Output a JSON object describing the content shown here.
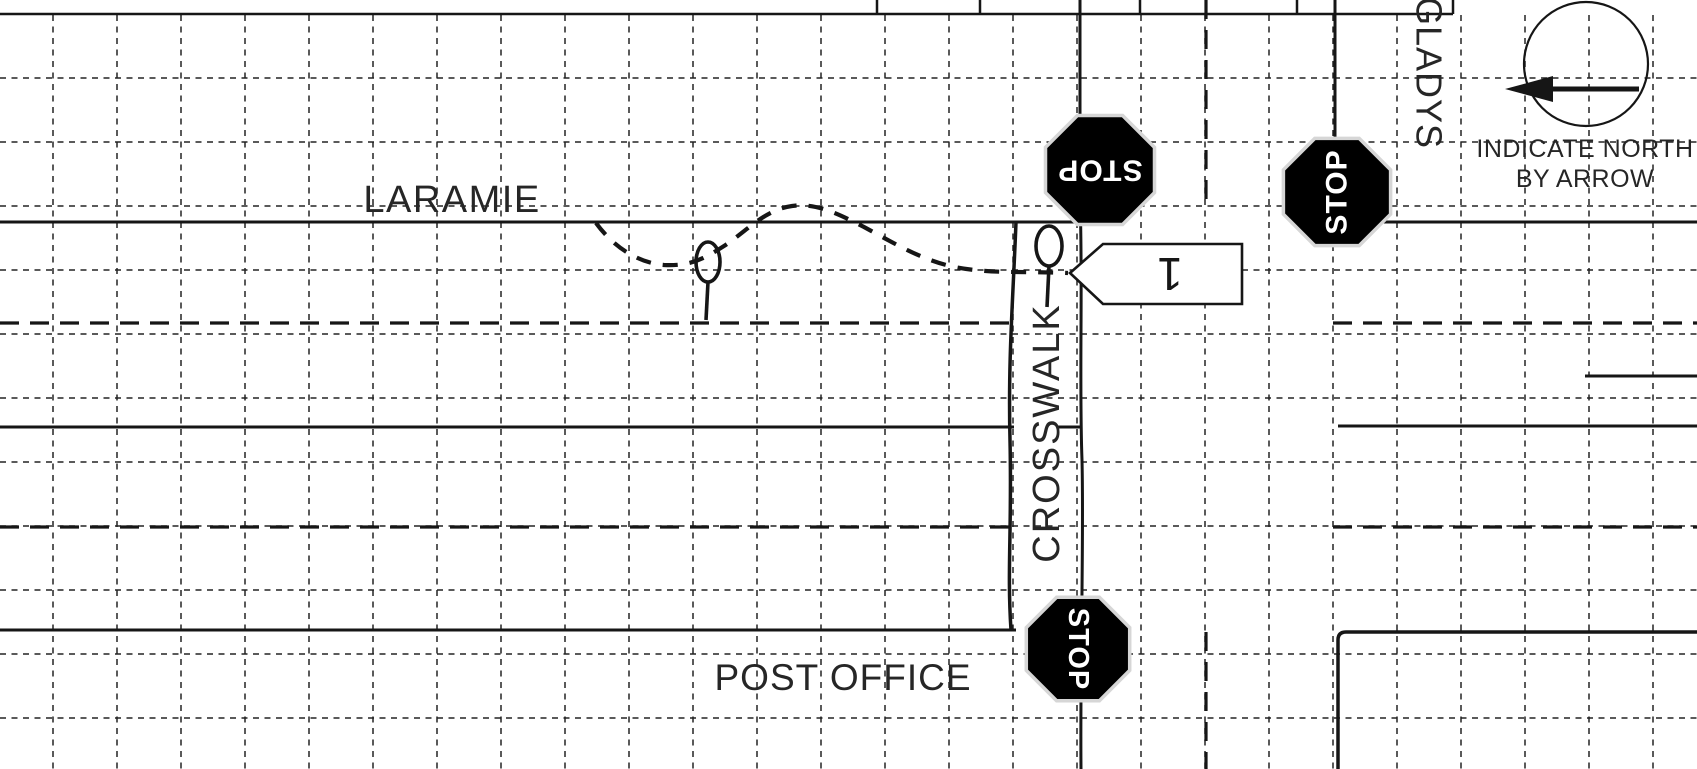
{
  "canvas": {
    "width": 1697,
    "height": 769,
    "background": "#ffffff",
    "ink": "#161616",
    "grid_color": "#232323",
    "halo_color": "#d6d6d6",
    "sign_fill": "#000000",
    "sign_text_color": "#ffffff",
    "paper_text_color": "#262626"
  },
  "grid": {
    "col_x0": 53,
    "row_y0": 78,
    "step": 64,
    "col_count": 26,
    "row_count": 11,
    "col_y1": 15,
    "col_y2": 769,
    "row_x1": 0,
    "row_x2": 1697,
    "dash": "6 5.5",
    "width": 1.5
  },
  "form_rules": [
    {
      "name": "form-header-rule",
      "x1": 0,
      "y1": 14,
      "x2": 1453,
      "y2": 14,
      "w": 2.5
    },
    {
      "name": "form-header-rule-corner",
      "x1": 1453,
      "y1": 14,
      "x2": 1453,
      "y2": 0,
      "w": 2.5
    },
    {
      "name": "form-header-tick-1",
      "x1": 877,
      "y1": 0,
      "x2": 877,
      "y2": 14,
      "w": 2.5
    },
    {
      "name": "form-header-tick-2",
      "x1": 980,
      "y1": 0,
      "x2": 980,
      "y2": 14,
      "w": 2.5
    },
    {
      "name": "form-header-tick-3",
      "x1": 1140,
      "y1": 0,
      "x2": 1140,
      "y2": 14,
      "w": 2.5
    },
    {
      "name": "form-header-tick-4",
      "x1": 1297,
      "y1": 0,
      "x2": 1297,
      "y2": 14,
      "w": 2.5
    }
  ],
  "street_lines": [
    {
      "name": "laramie-north-edge-west",
      "x1": 0,
      "y1": 222,
      "x2": 1079,
      "y2": 222,
      "w": 3
    },
    {
      "name": "laramie-north-edge-east",
      "x1": 1335,
      "y1": 222,
      "x2": 1697,
      "y2": 222,
      "w": 3
    },
    {
      "name": "shared-street-edge-west",
      "x1": 0,
      "y1": 427,
      "x2": 1014,
      "y2": 427,
      "w": 3
    },
    {
      "name": "shared-street-edge-mid",
      "x1": 1058,
      "y1": 427,
      "x2": 1081,
      "y2": 427,
      "w": 3
    },
    {
      "name": "shared-street-edge-east",
      "x1": 1338,
      "y1": 426,
      "x2": 1697,
      "y2": 426,
      "w": 3
    },
    {
      "name": "east-lane-line",
      "x1": 1585,
      "y1": 376,
      "x2": 1697,
      "y2": 376,
      "w": 3
    },
    {
      "name": "south-street-south-edge",
      "x1": 0,
      "y1": 630,
      "x2": 1016,
      "y2": 630,
      "w": 3
    },
    {
      "name": "gladys-east-edge",
      "x1": 1335,
      "y1": 0,
      "x2": 1335,
      "y2": 222,
      "w": 3
    }
  ],
  "heavy_dashed_lines": [
    {
      "name": "laramie-centerline-west",
      "x1": 0,
      "y1": 323,
      "x2": 1013,
      "y2": 323
    },
    {
      "name": "laramie-centerline-east",
      "x1": 1333,
      "y1": 323,
      "x2": 1697,
      "y2": 323
    },
    {
      "name": "south-street-centerline-west",
      "x1": 0,
      "y1": 527,
      "x2": 1010,
      "y2": 527
    },
    {
      "name": "south-street-centerline-east",
      "x1": 1333,
      "y1": 527,
      "x2": 1697,
      "y2": 527
    },
    {
      "name": "gladys-centerline-north",
      "x1": 1206,
      "y1": 0,
      "x2": 1206,
      "y2": 210
    },
    {
      "name": "gladys-centerline-south",
      "x1": 1206,
      "y1": 632,
      "x2": 1206,
      "y2": 769
    }
  ],
  "drawn_paths": [
    {
      "name": "gladys-west-edge-crosswalk-right",
      "w": 3,
      "d": "M 1080,0 L 1080,200 C 1083,280 1079,380 1082,460 C 1084,540 1080,660 1081,769"
    },
    {
      "name": "crosswalk-left-line",
      "w": 3.5,
      "d": "M 1016,222 C 1013,300 1008,360 1010,440 C 1012,530 1007,570 1011,630"
    },
    {
      "name": "se-corner-curb",
      "w": 3.5,
      "d": "M 1697,632 L 1346,632 Q 1338,632 1338,640 L 1338,769"
    },
    {
      "name": "vehicle-travel-path",
      "w": 4.2,
      "dash": "15 12",
      "d": "M 596,223 C 615,249 640,263 664,265 C 690,266 702,260 724,246 C 747,231 764,210 792,206 C 814,203 833,211 864,227 C 897,245 921,259 950,266 C 987,274 1012,271 1068,273"
    }
  ],
  "signs": [
    {
      "name": "stop-sign-north",
      "label": "STOP",
      "cx": 1100,
      "cy": 170,
      "r": 59,
      "label_rot": 180,
      "font": 30
    },
    {
      "name": "stop-sign-east",
      "label": "STOP",
      "cx": 1337,
      "cy": 192,
      "r": 58,
      "label_rot": -90,
      "font": 30
    },
    {
      "name": "stop-sign-south",
      "label": "STOP",
      "cx": 1078,
      "cy": 649,
      "r": 56,
      "label_rot": 90,
      "font": 29
    }
  ],
  "pedestrians": [
    {
      "name": "pedestrian-symbol-west",
      "cx": 708,
      "cy": 262,
      "rx": 12,
      "ry": 20,
      "stick_y2": 320
    },
    {
      "name": "pedestrian-symbol-east",
      "cx": 1049,
      "cy": 246,
      "rx": 13,
      "ry": 20,
      "stick_y2": 307
    }
  ],
  "vehicle": {
    "name": "vehicle-1-marker",
    "label": "1",
    "points": "1070,273 1103,244 1242,244 1242,304 1103,304",
    "label_x": 1170,
    "label_y": 274,
    "label_rot": 180,
    "font": 46
  },
  "labels": [
    {
      "name": "street-label-laramie",
      "text": "LARAMIE",
      "x": 452,
      "y": 212,
      "size": 38,
      "ls": 1.5,
      "rot": 0
    },
    {
      "name": "landmark-label-post-office",
      "text": "POST OFFICE",
      "x": 843,
      "y": 690,
      "size": 37,
      "ls": 1,
      "rot": 0
    },
    {
      "name": "crosswalk-label",
      "text": "CROSSWALK",
      "x": 1047,
      "y": 433,
      "size": 38,
      "ls": 2,
      "rot": -90
    },
    {
      "name": "street-label-gladys",
      "text": "GLADYS",
      "x": 1429,
      "y": 73,
      "size": 36,
      "ls": 1,
      "rot": 90
    },
    {
      "name": "north-note-line-1",
      "text": "INDICATE NORTH",
      "x": 1585,
      "y": 157,
      "size": 25,
      "ls": 0.5,
      "rot": 0
    },
    {
      "name": "north-note-line-2",
      "text": "BY ARROW",
      "x": 1585,
      "y": 187,
      "size": 25,
      "ls": 0.5,
      "rot": 0
    }
  ],
  "north_indicator": {
    "name": "north-arrow",
    "cx": 1586,
    "cy": 64,
    "r": 62,
    "circle_w": 2.2,
    "shaft_x1": 1545,
    "shaft_x2": 1639,
    "shaft_y": 89,
    "shaft_w": 5,
    "head_points": "1505,89 1553,76 1553,102"
  }
}
